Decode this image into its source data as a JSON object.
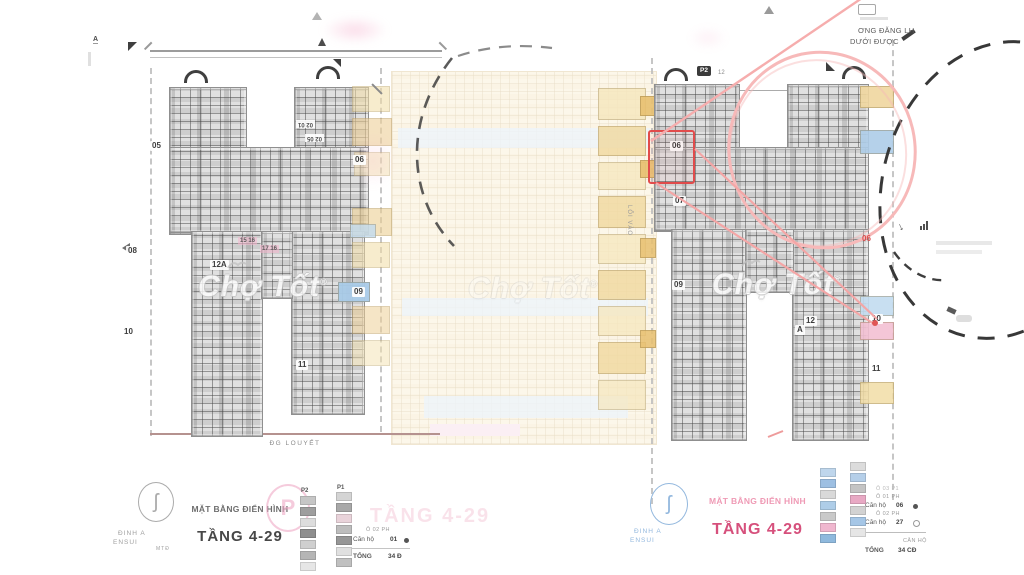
{
  "watermark": {
    "text": "Chợ Tốt",
    "reg": "®"
  },
  "brand": {
    "line1": "ĐINH A",
    "line2": "ENSUI",
    "line3": "MTĐ"
  },
  "titles": {
    "left_sub": "MẶT BẰNG ĐIỂN HÌNH",
    "left_main": "TẦNG 4-29",
    "right_sub": "MẶT BẰNG ĐIỂN HÌNH",
    "right_main": "TẦNG 4-29",
    "faded_main": "TẦNG 4-29"
  },
  "note": {
    "line1": "ƠNG ĐĂNG LH",
    "line2": "DƯỚI ĐƯỢC"
  },
  "left_plan": {
    "street": "ĐG LOUYẾT",
    "marker_a": "A",
    "flip_label_a": "02 01",
    "flip_label_b": "02 05",
    "strip_a": "15 16",
    "strip_b": "17 16",
    "units": [
      {
        "text": "05",
        "x": 150,
        "y": 141
      },
      {
        "text": "06",
        "x": 353,
        "y": 155
      },
      {
        "text": "08",
        "x": 126,
        "y": 246
      },
      {
        "text": "10",
        "x": 122,
        "y": 327
      },
      {
        "text": "12A",
        "x": 210,
        "y": 260
      },
      {
        "text": "09",
        "x": 352,
        "y": 287
      },
      {
        "text": "11",
        "x": 296,
        "y": 360
      }
    ],
    "highlights": [
      {
        "x": 352,
        "y": 86,
        "w": 36,
        "h": 24,
        "c": "#f2dda6",
        "o": 0.55
      },
      {
        "x": 352,
        "y": 118,
        "w": 38,
        "h": 26,
        "c": "#eed098",
        "o": 0.6
      },
      {
        "x": 354,
        "y": 152,
        "w": 34,
        "h": 22,
        "c": "#f4e2b0",
        "o": 0.5
      },
      {
        "x": 352,
        "y": 208,
        "w": 38,
        "h": 26,
        "c": "#eccf93",
        "o": 0.6
      },
      {
        "x": 352,
        "y": 242,
        "w": 36,
        "h": 24,
        "c": "#f2dda6",
        "o": 0.55
      },
      {
        "x": 350,
        "y": 224,
        "w": 24,
        "h": 12,
        "c": "#c3dcf0",
        "o": 0.8
      },
      {
        "x": 338,
        "y": 282,
        "w": 30,
        "h": 18,
        "c": "#a9cbe8",
        "o": 0.95
      },
      {
        "x": 352,
        "y": 306,
        "w": 36,
        "h": 26,
        "c": "#eed098",
        "o": 0.55
      },
      {
        "x": 352,
        "y": 340,
        "w": 36,
        "h": 24,
        "c": "#f4e2b0",
        "o": 0.5
      }
    ],
    "legend": {
      "col1": "P2",
      "col2": "P1",
      "swatches1": [
        {
          "c": "#c6c6c6"
        },
        {
          "c": "#9e9e9e"
        },
        {
          "c": "#dddddd"
        },
        {
          "c": "#8e8e8e"
        },
        {
          "c": "#cfcfcf"
        },
        {
          "c": "#b5b5b5"
        },
        {
          "c": "#e6e6e6"
        }
      ],
      "swatches2": [
        {
          "c": "#d4d4d4"
        },
        {
          "c": "#a8a8a8"
        },
        {
          "c": "#e9d3da"
        },
        {
          "c": "#bdbdbd"
        },
        {
          "c": "#969696"
        },
        {
          "c": "#e0e0e0"
        },
        {
          "c": "#c0c0c0"
        }
      ],
      "cap1": "Ô 02 PH",
      "row1_label": "Căn hộ",
      "row1_value": "01",
      "total_label": "TỔNG",
      "total_value": "34 Đ"
    }
  },
  "right_plan": {
    "badge1": "P2",
    "badge1_sub": "12",
    "entrance": "LỐI VÀO",
    "red_unit": "06",
    "units": [
      {
        "text": "06",
        "x": 670,
        "y": 141
      },
      {
        "text": "07",
        "x": 673,
        "y": 196
      },
      {
        "text": "09",
        "x": 672,
        "y": 280
      },
      {
        "text": "12",
        "x": 804,
        "y": 316
      },
      {
        "text": "A",
        "x": 795,
        "y": 325
      },
      {
        "text": "10",
        "x": 870,
        "y": 314
      },
      {
        "text": "11",
        "x": 870,
        "y": 364
      }
    ],
    "highlights_left": [
      {
        "x": 598,
        "y": 88,
        "w": 46,
        "h": 30,
        "c": "#f6e7bd",
        "o": 0.8
      },
      {
        "x": 598,
        "y": 126,
        "w": 46,
        "h": 28,
        "c": "#f1d99f",
        "o": 0.8
      },
      {
        "x": 598,
        "y": 162,
        "w": 46,
        "h": 26,
        "c": "#f6e7bd",
        "o": 0.75
      },
      {
        "x": 598,
        "y": 196,
        "w": 46,
        "h": 30,
        "c": "#f1d99f",
        "o": 0.8
      },
      {
        "x": 598,
        "y": 234,
        "w": 46,
        "h": 28,
        "c": "#f6e7bd",
        "o": 0.75
      },
      {
        "x": 598,
        "y": 270,
        "w": 46,
        "h": 28,
        "c": "#f1d99f",
        "o": 0.8
      },
      {
        "x": 598,
        "y": 306,
        "w": 46,
        "h": 28,
        "c": "#f6e7bd",
        "o": 0.75
      },
      {
        "x": 598,
        "y": 342,
        "w": 46,
        "h": 30,
        "c": "#f1d99f",
        "o": 0.8
      },
      {
        "x": 598,
        "y": 380,
        "w": 46,
        "h": 28,
        "c": "#f6e7bd",
        "o": 0.7
      },
      {
        "x": 640,
        "y": 96,
        "w": 14,
        "h": 18,
        "c": "#e8c070",
        "o": 0.9
      },
      {
        "x": 640,
        "y": 160,
        "w": 14,
        "h": 16,
        "c": "#e8c070",
        "o": 0.9
      },
      {
        "x": 640,
        "y": 238,
        "w": 14,
        "h": 18,
        "c": "#e8c070",
        "o": 0.85
      },
      {
        "x": 640,
        "y": 330,
        "w": 14,
        "h": 16,
        "c": "#e8c070",
        "o": 0.85
      },
      {
        "x": 703,
        "y": 326,
        "w": 34,
        "h": 14,
        "c": "#bcd7ee",
        "o": 0.9
      }
    ],
    "highlights_right": [
      {
        "x": 860,
        "y": 86,
        "w": 32,
        "h": 20,
        "c": "#f0d79f",
        "o": 0.9
      },
      {
        "x": 860,
        "y": 130,
        "w": 32,
        "h": 22,
        "c": "#aecde8",
        "o": 0.9
      },
      {
        "x": 860,
        "y": 296,
        "w": 32,
        "h": 18,
        "c": "#c3dcf0",
        "o": 0.9
      },
      {
        "x": 860,
        "y": 322,
        "w": 32,
        "h": 16,
        "c": "#f3c0d3",
        "o": 0.9
      },
      {
        "x": 860,
        "y": 382,
        "w": 32,
        "h": 20,
        "c": "#f2dda6",
        "o": 0.85
      }
    ],
    "legend": {
      "swatches1": [
        {
          "c": "#bfd6ec"
        },
        {
          "c": "#9dbfe2"
        },
        {
          "c": "#d9d9d9"
        },
        {
          "c": "#aecde8"
        },
        {
          "c": "#c9c9c9"
        },
        {
          "c": "#f0b7cf"
        },
        {
          "c": "#8fb9dd"
        }
      ],
      "swatches2": [
        {
          "c": "#dcdcdc"
        },
        {
          "c": "#b5cfe9"
        },
        {
          "c": "#c4c4c4"
        },
        {
          "c": "#e8a9c4"
        },
        {
          "c": "#d2d2d2"
        },
        {
          "c": "#a5c6e6"
        },
        {
          "c": "#e6e6e6"
        }
      ],
      "cap0": "Ô 03 P1",
      "cap1": "Ô 01 PH",
      "row1_label": "Căn hộ",
      "row1_value": "06",
      "cap2": "Ô 02 PH",
      "row2_label": "Căn hộ",
      "row2_value": "27",
      "note": "CĂN HỘ",
      "total_label": "TỔNG",
      "total_value": "34 CĐ"
    }
  }
}
